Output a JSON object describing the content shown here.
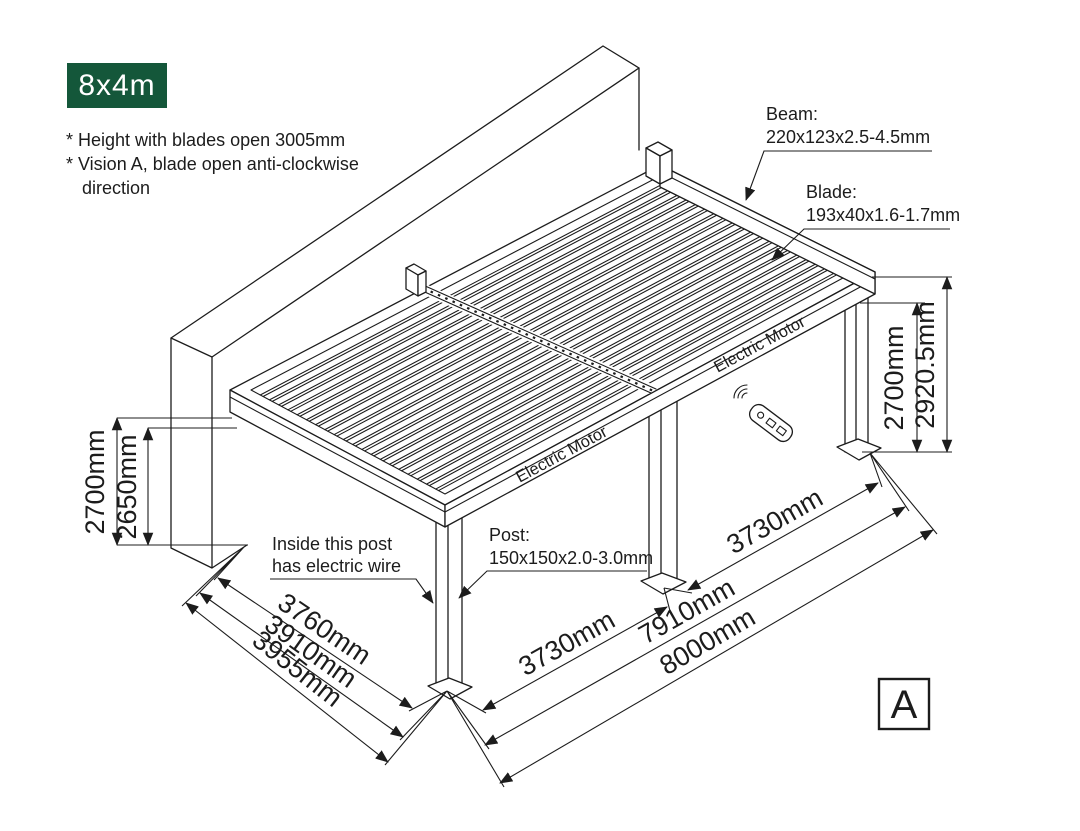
{
  "badge": {
    "label": "8x4m",
    "bg_color": "#14573A",
    "text_color": "#FFFFFF"
  },
  "notes": {
    "line1": "* Height with blades open 3005mm",
    "line2": "* Vision A, blade open anti-clockwise",
    "line3": "direction"
  },
  "callouts": {
    "beam": {
      "title": "Beam:",
      "spec": "220x123x2.5-4.5mm"
    },
    "blade": {
      "title": "Blade:",
      "spec": "193x40x1.6-1.7mm"
    },
    "post": {
      "title": "Post:",
      "spec": "150x150x2.0-3.0mm"
    },
    "wire": {
      "line1": "Inside this post",
      "line2": "has electric wire"
    }
  },
  "motor_labels": {
    "left": "Electric Motor",
    "right": "Electric Motor"
  },
  "dimensions": {
    "wall_height_outer": "2700mm",
    "wall_height_inner": "2650mm",
    "post_height": "2700mm",
    "total_height": "2920.5mm",
    "depth_inner": "3760mm",
    "depth_mid": "3910mm",
    "depth_outer": "3955mm",
    "bay_left": "3730mm",
    "bay_right": "3730mm",
    "post_span": "7910mm",
    "total_width": "8000mm"
  },
  "view_label": "A",
  "colors": {
    "line": "#1C1C1C",
    "badge_green": "#14573A"
  }
}
